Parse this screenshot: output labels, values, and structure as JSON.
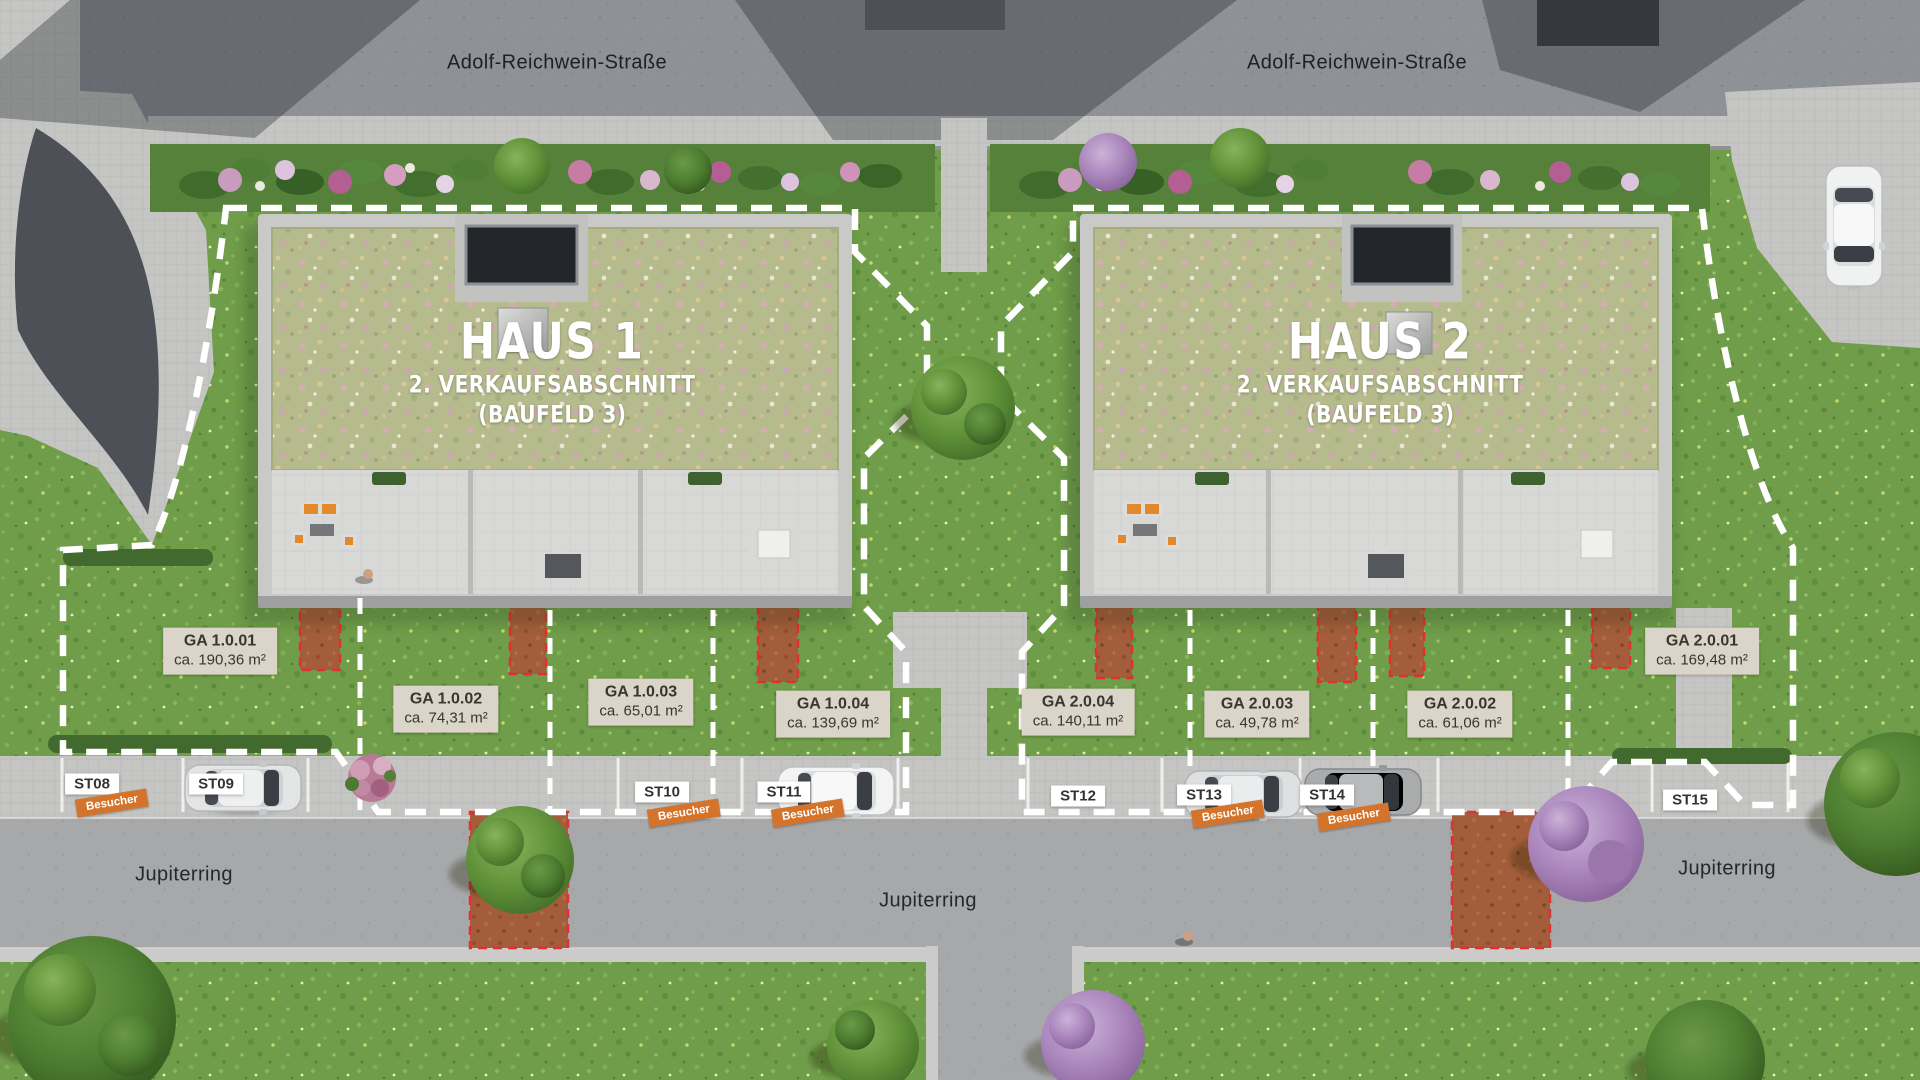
{
  "streets": {
    "adolf_left": "Adolf-Reichwein-Straße",
    "adolf_right": "Adolf-Reichwein-Straße",
    "jupiter_left": "Jupiterring",
    "jupiter_center": "Jupiterring",
    "jupiter_right": "Jupiterring"
  },
  "buildings": [
    {
      "title": "HAUS 1",
      "subtitle": "2. VERKAUFSABSCHNITT",
      "note": "(BAUFELD 3)"
    },
    {
      "title": "HAUS 2",
      "subtitle": "2. VERKAUFSABSCHNITT",
      "note": "(BAUFELD 3)"
    }
  ],
  "garden_areas": [
    {
      "id": "GA 1.0.01",
      "size": "ca. 190,36 m²"
    },
    {
      "id": "GA 1.0.02",
      "size": "ca. 74,31 m²"
    },
    {
      "id": "GA 1.0.03",
      "size": "ca. 65,01 m²"
    },
    {
      "id": "GA 1.0.04",
      "size": "ca. 139,69 m²"
    },
    {
      "id": "GA 2.0.04",
      "size": "ca. 140,11 m²"
    },
    {
      "id": "GA 2.0.03",
      "size": "ca. 49,78 m²"
    },
    {
      "id": "GA 2.0.02",
      "size": "ca. 61,06 m²"
    },
    {
      "id": "GA 2.0.01",
      "size": "ca. 169,48 m²"
    }
  ],
  "parking_spots": [
    {
      "id": "ST08",
      "tag": "Besucher"
    },
    {
      "id": "ST09",
      "tag": ""
    },
    {
      "id": "ST10",
      "tag": "Besucher"
    },
    {
      "id": "ST11",
      "tag": "Besucher"
    },
    {
      "id": "ST12",
      "tag": ""
    },
    {
      "id": "ST13",
      "tag": "Besucher"
    },
    {
      "id": "ST14",
      "tag": "Besucher"
    },
    {
      "id": "ST15",
      "tag": ""
    }
  ],
  "colors": {
    "boundary_dash": "#ffffff",
    "besucher_orange": "#d4742c",
    "ga_label_bg": "#dbd4c8",
    "st_label_bg": "#ffffff",
    "terracotta_patch": "#a35d3a",
    "patch_dash_red": "#e03030",
    "grass_green": "#6f9d49",
    "sedum_roof": "#b5bb8d",
    "asphalt_top": "#8e9196",
    "asphalt_bottom": "#a6a8aa"
  }
}
